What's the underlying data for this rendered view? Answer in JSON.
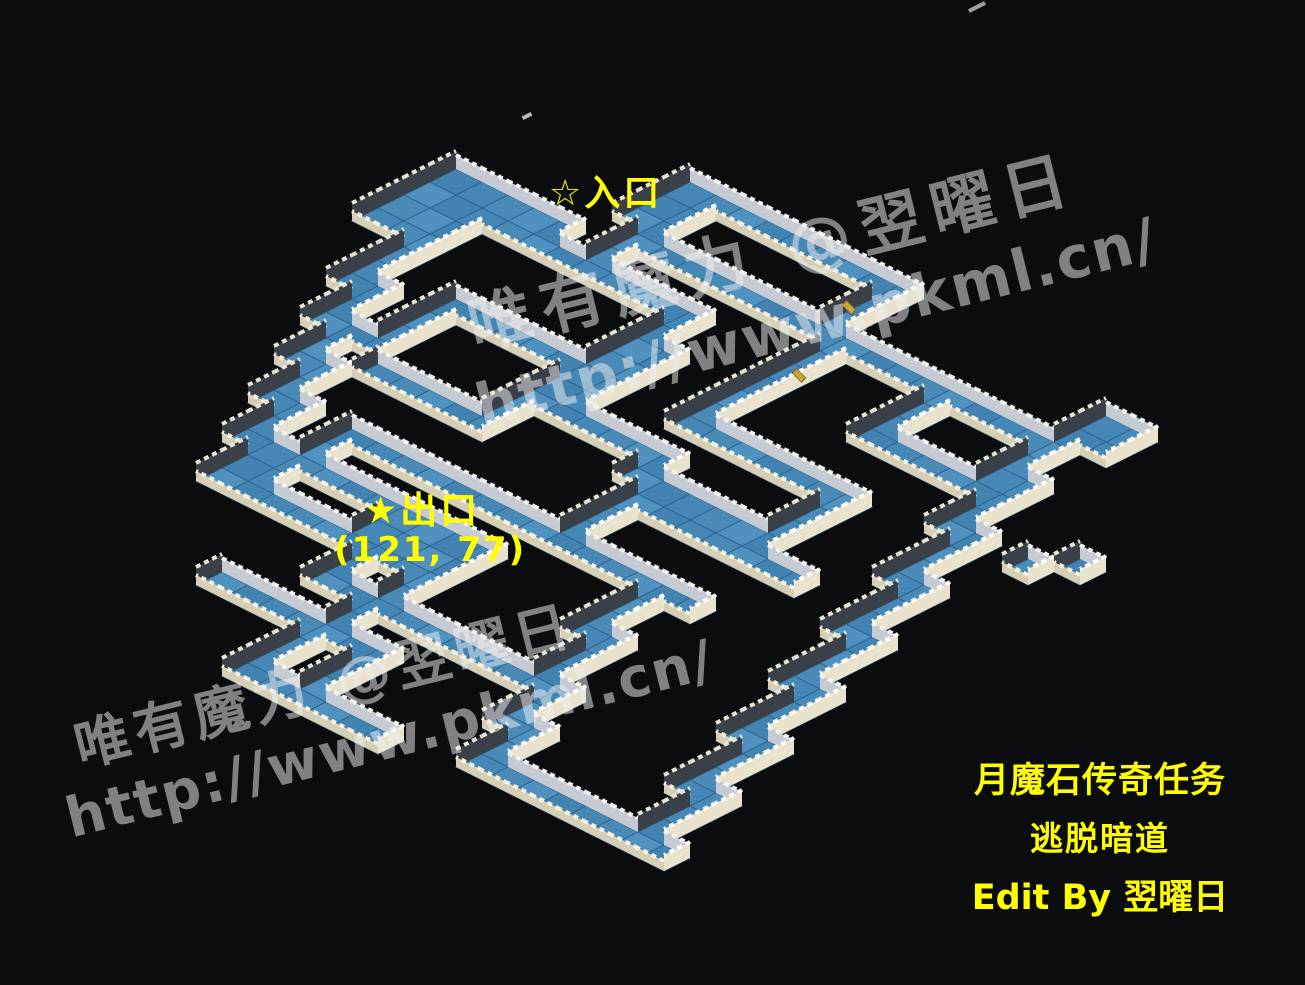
{
  "map_labels": {
    "entrance": "☆入口",
    "exit": "★出口",
    "exit_coords": "(121, 77)"
  },
  "caption": {
    "line1": "月魔石传奇任务",
    "line2": "逃脱暗道",
    "line3": "Edit By 翌曜日"
  },
  "watermark": {
    "brand": "唯有魔力 @翌曜日",
    "url": "http://www.pkml.cn/"
  },
  "colors": {
    "background": "#0b0c0e",
    "label_yellow": "#ffff00",
    "watermark_gray": "rgba(238,238,238,0.52)",
    "water_blue": "#4a8ab6",
    "wall_cream": "#e9e3cd",
    "wall_gray": "#c6cbd3",
    "wall_dark": "#3a4048"
  },
  "map": {
    "hw": 26,
    "hh": 13,
    "ox": 560,
    "oy": 130,
    "palette": {
      "floor": [
        "#4383b1",
        "#4f92c0",
        "#4a8ab6",
        "#4588b8"
      ],
      "floor_stroke": "#2f6792",
      "walls": {
        "nw": {
          "h": 18,
          "face": "#3a4048",
          "crest": "#e9e5d2"
        },
        "ne": {
          "h": 14,
          "face": "#c6cbd3",
          "crest": "#f4f4ee"
        },
        "se": {
          "h": 16,
          "face": "#e9e3cd",
          "crest": "#ffffff"
        },
        "sw": {
          "h": 10,
          "face": "#d6cfb6",
          "crest": "#f6f2e2"
        }
      }
    },
    "rects": [
      [
        0,
        4,
        3,
        4
      ],
      [
        12,
        18,
        4,
        3
      ]
    ],
    "segments": [
      [
        3,
        5,
        "dr",
        8
      ],
      [
        2,
        8,
        "dl",
        3
      ],
      [
        3,
        10,
        "dr",
        1
      ],
      [
        3,
        11,
        "dl",
        2
      ],
      [
        4,
        12,
        "dr",
        1
      ],
      [
        4,
        13,
        "dl",
        2
      ],
      [
        5,
        14,
        "dr",
        1
      ],
      [
        5,
        15,
        "dl",
        2
      ],
      [
        6,
        16,
        "dr",
        1
      ],
      [
        6,
        17,
        "dl",
        2
      ],
      [
        7,
        18,
        "dr",
        1
      ],
      [
        7,
        19,
        "dl",
        2
      ],
      [
        8,
        20,
        "dr",
        8
      ],
      [
        10,
        6,
        "dl",
        8
      ],
      [
        5,
        9,
        "dr",
        6
      ],
      [
        5,
        10,
        "dl",
        3
      ],
      [
        6,
        13,
        "dr",
        4
      ],
      [
        8,
        16,
        "dr",
        14
      ],
      [
        8,
        17,
        "dl",
        3
      ],
      [
        9,
        18,
        "dr",
        3
      ],
      [
        13,
        21,
        "dl",
        2
      ],
      [
        14,
        22,
        "dr",
        7
      ],
      [
        15,
        21,
        "dl",
        6
      ],
      [
        11,
        24,
        "dr",
        7
      ],
      [
        17,
        24,
        "dl",
        4
      ],
      [
        15,
        27,
        "dr",
        6
      ],
      [
        20,
        17,
        "dl",
        3
      ],
      [
        21,
        19,
        "dr",
        1
      ],
      [
        21,
        20,
        "dl",
        3
      ],
      [
        22,
        22,
        "dr",
        1
      ],
      [
        22,
        23,
        "dl",
        2
      ],
      [
        23,
        24,
        "dr",
        1
      ],
      [
        23,
        25,
        "dl",
        2
      ],
      [
        24,
        26,
        "dr",
        7
      ],
      [
        5,
        0,
        "dr",
        9
      ],
      [
        13,
        0,
        "dl",
        4
      ],
      [
        6,
        3,
        "dr",
        7
      ],
      [
        6,
        1,
        "dl",
        2
      ],
      [
        5,
        1,
        "dl",
        2
      ],
      [
        3,
        4,
        "dr",
        2
      ],
      [
        6,
        4,
        "dl",
        1
      ],
      [
        14,
        3,
        "dr",
        8
      ],
      [
        22,
        1,
        "dl",
        2
      ],
      [
        23,
        1,
        "dl",
        2
      ],
      [
        14,
        4,
        "dl",
        6
      ],
      [
        15,
        9,
        "dr",
        6
      ],
      [
        20,
        9,
        "dl",
        4
      ],
      [
        15,
        12,
        "dr",
        5
      ],
      [
        18,
        4,
        "dl",
        3
      ],
      [
        19,
        6,
        "dr",
        4
      ],
      [
        22,
        3,
        "dl",
        3
      ],
      [
        23,
        5,
        "dr",
        1
      ],
      [
        23,
        6,
        "dl",
        3
      ],
      [
        24,
        8,
        "dr",
        1
      ],
      [
        24,
        9,
        "dl",
        3
      ],
      [
        25,
        11,
        "dr",
        1
      ],
      [
        25,
        12,
        "dl",
        3
      ],
      [
        26,
        14,
        "dr",
        1
      ],
      [
        26,
        15,
        "dl",
        3
      ],
      [
        27,
        17,
        "dr",
        1
      ],
      [
        27,
        18,
        "dl",
        3
      ],
      [
        28,
        20,
        "dr",
        1
      ],
      [
        28,
        21,
        "dl",
        3
      ],
      [
        29,
        23,
        "dr",
        1
      ],
      [
        29,
        24,
        "dl",
        2
      ],
      [
        11,
        7,
        "dr",
        1
      ],
      [
        11,
        8,
        "dl",
        4
      ],
      [
        12,
        11,
        "dr",
        4
      ],
      [
        16,
        13,
        "dl",
        3
      ],
      [
        17,
        13,
        "dr",
        6
      ]
    ],
    "cells": [
      [
        27,
        7
      ],
      [
        26,
        8
      ]
    ]
  },
  "objects": {
    "gold_items": [
      {
        "x": 842,
        "y": 302
      },
      {
        "x": 792,
        "y": 370
      }
    ]
  }
}
